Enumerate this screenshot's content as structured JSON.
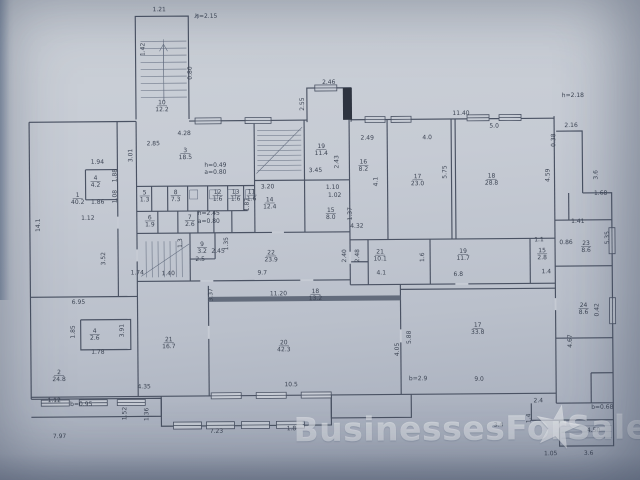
{
  "watermark": {
    "text": "BusinessesForSale",
    "star": "★",
    "color": "rgba(255,255,255,0.48)"
  },
  "photo": {
    "paper_color": "#c6cbd4",
    "edge_color": "#4f6a86",
    "shadow_color": "#5c6a85"
  },
  "plan": {
    "line_color": "#4a5263",
    "thin_color": "#67718322",
    "thin_stroke": "#646e80",
    "text_color": "#3d4554",
    "paper": "#c6cbd4",
    "walls": [
      "M30 120 H137",
      "M137 118 V15 H190 V118",
      "M190 120 H308",
      "M308 122 V88 H352 V122",
      "M352 120 H555",
      "M30 120 V397",
      "M555 118 V405",
      "M557 133 H583 V195",
      "M583 195 H612 V405 H555",
      "M555 222 H612",
      "M555 268 H612",
      "M555 340 H612",
      "M569 195 V222",
      "M590 375 V405",
      "M590 375 H612",
      "M530 405 V422 H558 V448 H612 V405",
      "M558 422 H612",
      "M30 395 H555",
      "M160 395 V425 H330 V395",
      "M330 395 V418 H410 V395",
      "M30 397 H160 M30 415 H160 M160 397 V415",
      "M118 120 V295",
      "M86 168 H118 M86 168 V198 M86 198 H118",
      "M30 295 H137",
      "M137 120 V395",
      "M137 185 H255",
      "M255 180 H350",
      "M255 120 V232",
      "M305 120 V232",
      "M350 118 V285",
      "M137 210 H248",
      "M152 185 V210 M168 185 V210 M188 185 V210 M208 185 V210 M228 185 V210 M244 185 V210",
      "M158 210 V232 M178 210 V232 M198 210 V232 M214 210 V232 M232 210 V232",
      "M137 232 H350",
      "M137 280 H350",
      "M190 232 V280",
      "M215 232 V258 M190 258 H215",
      "M388 120 V240",
      "M452 120 V240 M456 120 V240",
      "M350 240 H555",
      "M368 240 V285 M350 262 H368",
      "M430 240 V285",
      "M530 240 V285",
      "M350 285 H555",
      "M208 285 V395",
      "M400 285 V395",
      "M400 290 H555",
      "M208 300 H400",
      "M80 318 H130 V348 H80 V318"
    ],
    "thin": [
      "M142 40 H188 M142 47 H188 M142 54 H188 M142 61 H188 M142 68 H188 M142 75 H188 M142 82 H188 M142 89 H188 M142 96 H188",
      "M165 38 V100",
      "M165 98 V44 M161 50 L165 43 L169 50",
      "M258 130 H302 M258 135 H302 M258 140 H302 M258 145 H302 M258 150 H302 M258 155 H302 M258 160 H302 M258 165 H302 M258 170 H302",
      "M257 173 L303 127",
      "M146 240 V276 M152 240 V276 M158 240 V276 M164 240 V276 M170 240 V276 M176 240 V276 M182 240 V276",
      "M141 275 L189 243",
      "M190 189 h8 v9 h-8 v-9 M210 189 h8 v9 h-8 v-9 M228 189 h8 v9 h-8 v-9 M246 189 h8 v9 h-8 v-9",
      "M560 428 H610 M560 434 H610 M560 440 H610",
      "M200 13 l-4 4 M200 13 l-1 5"
    ],
    "gaps": [
      "M200 280 H213",
      "M300 280 H313",
      "M455 285 H468",
      "M137 248 V260",
      "M350 252 V264",
      "M118 215 V227",
      "M208 325 V338",
      "M400 330 V343",
      "M555 300 V312",
      "M272 232 H284"
    ],
    "windows": [
      [
        196,
        117,
        26,
        6
      ],
      [
        246,
        117,
        26,
        6
      ],
      [
        366,
        117,
        20,
        6
      ],
      [
        392,
        117,
        20,
        6
      ],
      [
        468,
        116,
        22,
        6
      ],
      [
        500,
        116,
        22,
        6
      ],
      [
        316,
        85,
        22,
        6
      ],
      [
        609,
        230,
        6,
        26
      ],
      [
        609,
        300,
        6,
        26
      ],
      [
        210,
        392,
        30,
        6
      ],
      [
        255,
        392,
        30,
        6
      ],
      [
        300,
        392,
        30,
        6
      ],
      [
        172,
        421,
        28,
        7
      ],
      [
        205,
        421,
        28,
        7
      ],
      [
        240,
        421,
        28,
        7
      ],
      [
        275,
        421,
        28,
        7
      ],
      [
        40,
        398,
        28,
        6
      ],
      [
        78,
        398,
        28,
        6
      ],
      [
        116,
        398,
        28,
        6
      ]
    ],
    "fills": [
      {
        "x": 344,
        "y": 88,
        "w": 9,
        "h": 32,
        "c": "#2e3440"
      },
      {
        "x": 208,
        "y": 296,
        "w": 192,
        "h": 5,
        "c": "#636c7c"
      }
    ],
    "rooms": [
      {
        "n": "10",
        "a": "12.2",
        "x": 163,
        "y": 103
      },
      {
        "n": "1",
        "a": "40.2",
        "x": 78,
        "y": 195
      },
      {
        "n": "4",
        "a": "4.2",
        "x": 96,
        "y": 178
      },
      {
        "n": "3",
        "a": "18.5",
        "x": 186,
        "y": 151
      },
      {
        "n": "5",
        "a": "1.3",
        "x": 145,
        "y": 193
      },
      {
        "n": "8",
        "a": "7.3",
        "x": 176,
        "y": 193
      },
      {
        "n": "12",
        "a": "1.6",
        "x": 218,
        "y": 193
      },
      {
        "n": "13",
        "a": "1.6",
        "x": 236,
        "y": 193
      },
      {
        "n": "11",
        "a": "1.6",
        "x": 252,
        "y": 193
      },
      {
        "n": "6",
        "a": "1.9",
        "x": 150,
        "y": 218
      },
      {
        "n": "7",
        "a": "2.6",
        "x": 190,
        "y": 218
      },
      {
        "n": "9",
        "a": "3.2",
        "x": 202,
        "y": 245
      },
      {
        "n": "22",
        "a": "23.9",
        "x": 271,
        "y": 254
      },
      {
        "n": "14",
        "a": "12.4",
        "x": 270,
        "y": 201
      },
      {
        "n": "19",
        "a": "11.4",
        "x": 322,
        "y": 148
      },
      {
        "n": "15",
        "a": "8.0",
        "x": 331,
        "y": 212
      },
      {
        "n": "16",
        "a": "8.2",
        "x": 364,
        "y": 164
      },
      {
        "n": "17",
        "a": "23.0",
        "x": 418,
        "y": 179
      },
      {
        "n": "18",
        "a": "28.8",
        "x": 492,
        "y": 179
      },
      {
        "n": "21",
        "a": "10.1",
        "x": 380,
        "y": 254
      },
      {
        "n": "19",
        "a": "11.7",
        "x": 463,
        "y": 254
      },
      {
        "n": "15",
        "a": "2.8",
        "x": 542,
        "y": 254
      },
      {
        "n": "18",
        "a": "13.2",
        "x": 315,
        "y": 293
      },
      {
        "n": "20",
        "a": "42.3",
        "x": 283,
        "y": 344
      },
      {
        "n": "21",
        "a": "16.7",
        "x": 168,
        "y": 340
      },
      {
        "n": "2",
        "a": "24.8",
        "x": 58,
        "y": 372
      },
      {
        "n": "4",
        "a": "2.6",
        "x": 94,
        "y": 331
      },
      {
        "n": "17",
        "a": "33.8",
        "x": 477,
        "y": 328
      },
      {
        "n": "23",
        "a": "8.6",
        "x": 586,
        "y": 247
      },
      {
        "n": "24",
        "a": "8.6",
        "x": 583,
        "y": 309
      }
    ],
    "dims": [
      {
        "t": "1.21",
        "x": 161,
        "y": 10,
        "r": 0
      },
      {
        "t": "h=2.15",
        "x": 208,
        "y": 17,
        "r": 0
      },
      {
        "t": "1.42",
        "x": 146,
        "y": 48,
        "r": -90
      },
      {
        "t": "0.80",
        "x": 193,
        "y": 72,
        "r": -90
      },
      {
        "t": "2.46",
        "x": 330,
        "y": 84,
        "r": 0
      },
      {
        "t": "2.55",
        "x": 305,
        "y": 104,
        "r": -90
      },
      {
        "t": "h=2.18",
        "x": 574,
        "y": 99,
        "r": 0
      },
      {
        "t": "2.16",
        "x": 572,
        "y": 129,
        "r": 0
      },
      {
        "t": "0.38",
        "x": 556,
        "y": 142,
        "r": -90
      },
      {
        "t": "3.6",
        "x": 598,
        "y": 177,
        "r": -90
      },
      {
        "t": "1.68",
        "x": 601,
        "y": 197,
        "r": 0
      },
      {
        "t": "4.28",
        "x": 185,
        "y": 134,
        "r": 0
      },
      {
        "t": "2.85",
        "x": 154,
        "y": 144,
        "r": 0
      },
      {
        "t": "3.01",
        "x": 133,
        "y": 154,
        "r": -90
      },
      {
        "t": "11.40",
        "x": 462,
        "y": 116,
        "r": 0
      },
      {
        "t": "2.49",
        "x": 368,
        "y": 140,
        "r": 0
      },
      {
        "t": "4.0",
        "x": 428,
        "y": 140,
        "r": 0
      },
      {
        "t": "5.0",
        "x": 495,
        "y": 129,
        "r": 0
      },
      {
        "t": "5.75",
        "x": 447,
        "y": 173,
        "r": -90
      },
      {
        "t": "4.59",
        "x": 550,
        "y": 177,
        "r": -90
      },
      {
        "t": "4.1",
        "x": 378,
        "y": 182,
        "r": -90
      },
      {
        "t": "1.37",
        "x": 352,
        "y": 214,
        "r": -90
      },
      {
        "t": "3.20",
        "x": 268,
        "y": 188,
        "r": 0
      },
      {
        "t": "1.87",
        "x": 249,
        "y": 204,
        "r": -90
      },
      {
        "t": "3.45",
        "x": 316,
        "y": 172,
        "r": 0
      },
      {
        "t": "2.43",
        "x": 339,
        "y": 162,
        "r": -90
      },
      {
        "t": "1.10",
        "x": 333,
        "y": 189,
        "r": 0
      },
      {
        "t": "1.02",
        "x": 335,
        "y": 197,
        "r": 0
      },
      {
        "t": "4.32",
        "x": 357,
        "y": 228,
        "r": 0
      },
      {
        "t": "h=0.49",
        "x": 216,
        "y": 166,
        "r": 0
      },
      {
        "t": "a=0.80",
        "x": 216,
        "y": 173,
        "r": 0
      },
      {
        "t": "h=2.45",
        "x": 209,
        "y": 214,
        "r": 0
      },
      {
        "t": "a=0.80",
        "x": 209,
        "y": 222,
        "r": 0
      },
      {
        "t": "14.1",
        "x": 40,
        "y": 223,
        "r": -90
      },
      {
        "t": "1.94",
        "x": 98,
        "y": 162,
        "r": 0
      },
      {
        "t": "1.88",
        "x": 117,
        "y": 174,
        "r": -90
      },
      {
        "t": "1.08",
        "x": 117,
        "y": 195,
        "r": -90
      },
      {
        "t": "1.86",
        "x": 98,
        "y": 202,
        "r": 0
      },
      {
        "t": "1.12",
        "x": 88,
        "y": 218,
        "r": 0
      },
      {
        "t": "3.52",
        "x": 105,
        "y": 257,
        "r": -90
      },
      {
        "t": "6.95",
        "x": 78,
        "y": 302,
        "r": 0
      },
      {
        "t": "3.91",
        "x": 123,
        "y": 329,
        "r": -90
      },
      {
        "t": "1.85",
        "x": 74,
        "y": 330,
        "r": -90
      },
      {
        "t": "1.78",
        "x": 97,
        "y": 352,
        "r": 0
      },
      {
        "t": "1.12",
        "x": 53,
        "y": 400,
        "r": 0
      },
      {
        "t": "b=0.95",
        "x": 80,
        "y": 404,
        "r": 0
      },
      {
        "t": "7.97",
        "x": 58,
        "y": 436,
        "r": 0
      },
      {
        "t": "4.35",
        "x": 143,
        "y": 387,
        "r": 0
      },
      {
        "t": "3.37",
        "x": 212,
        "y": 294,
        "r": -90
      },
      {
        "t": "11.20",
        "x": 278,
        "y": 295,
        "r": 0
      },
      {
        "t": "9.7",
        "x": 262,
        "y": 274,
        "r": 0
      },
      {
        "t": "1.74",
        "x": 137,
        "y": 273,
        "r": 0
      },
      {
        "t": "1.40",
        "x": 168,
        "y": 274,
        "r": 0
      },
      {
        "t": "2.45",
        "x": 218,
        "y": 252,
        "r": 0
      },
      {
        "t": "2.5",
        "x": 200,
        "y": 260,
        "r": 0
      },
      {
        "t": "1.3",
        "x": 182,
        "y": 242,
        "r": -90
      },
      {
        "t": "1.35",
        "x": 228,
        "y": 243,
        "r": -90
      },
      {
        "t": "10.5",
        "x": 290,
        "y": 386,
        "r": 0
      },
      {
        "t": "4.05",
        "x": 398,
        "y": 350,
        "r": -90
      },
      {
        "t": "5.88",
        "x": 410,
        "y": 338,
        "r": -90
      },
      {
        "t": "b=2.9",
        "x": 417,
        "y": 381,
        "r": 0
      },
      {
        "t": "9.0",
        "x": 478,
        "y": 382,
        "r": 0
      },
      {
        "t": "6.8",
        "x": 458,
        "y": 277,
        "r": 0
      },
      {
        "t": "4.1",
        "x": 381,
        "y": 275,
        "r": 0
      },
      {
        "t": "2.40",
        "x": 346,
        "y": 256,
        "r": -90
      },
      {
        "t": "2.48",
        "x": 359,
        "y": 256,
        "r": -90
      },
      {
        "t": "1.6",
        "x": 424,
        "y": 258,
        "r": -90
      },
      {
        "t": "1.1",
        "x": 539,
        "y": 243,
        "r": 0
      },
      {
        "t": "1.4",
        "x": 546,
        "y": 275,
        "r": 0
      },
      {
        "t": "5.35",
        "x": 609,
        "y": 240,
        "r": -90
      },
      {
        "t": "0.86",
        "x": 566,
        "y": 246,
        "r": 0
      },
      {
        "t": "1.41",
        "x": 578,
        "y": 225,
        "r": 0
      },
      {
        "t": "4.67",
        "x": 571,
        "y": 343,
        "r": -90
      },
      {
        "t": "0.42",
        "x": 598,
        "y": 312,
        "r": -90
      },
      {
        "t": "2.4",
        "x": 537,
        "y": 404,
        "r": 0
      },
      {
        "t": "1.4",
        "x": 529,
        "y": 420,
        "r": -90
      },
      {
        "t": "3.4",
        "x": 497,
        "y": 428,
        "r": 0
      },
      {
        "t": "b=0.68",
        "x": 601,
        "y": 411,
        "r": 0
      },
      {
        "t": "4.50",
        "x": 592,
        "y": 434,
        "r": 0
      },
      {
        "t": "1.05",
        "x": 549,
        "y": 457,
        "r": 0
      },
      {
        "t": "3.6",
        "x": 587,
        "y": 457,
        "r": 0
      },
      {
        "t": "1.8",
        "x": 290,
        "y": 430,
        "r": 0
      },
      {
        "t": "7.23",
        "x": 215,
        "y": 432,
        "r": 0
      },
      {
        "t": "1.52",
        "x": 125,
        "y": 412,
        "r": -90
      },
      {
        "t": "1.36",
        "x": 147,
        "y": 413,
        "r": -90
      }
    ]
  }
}
